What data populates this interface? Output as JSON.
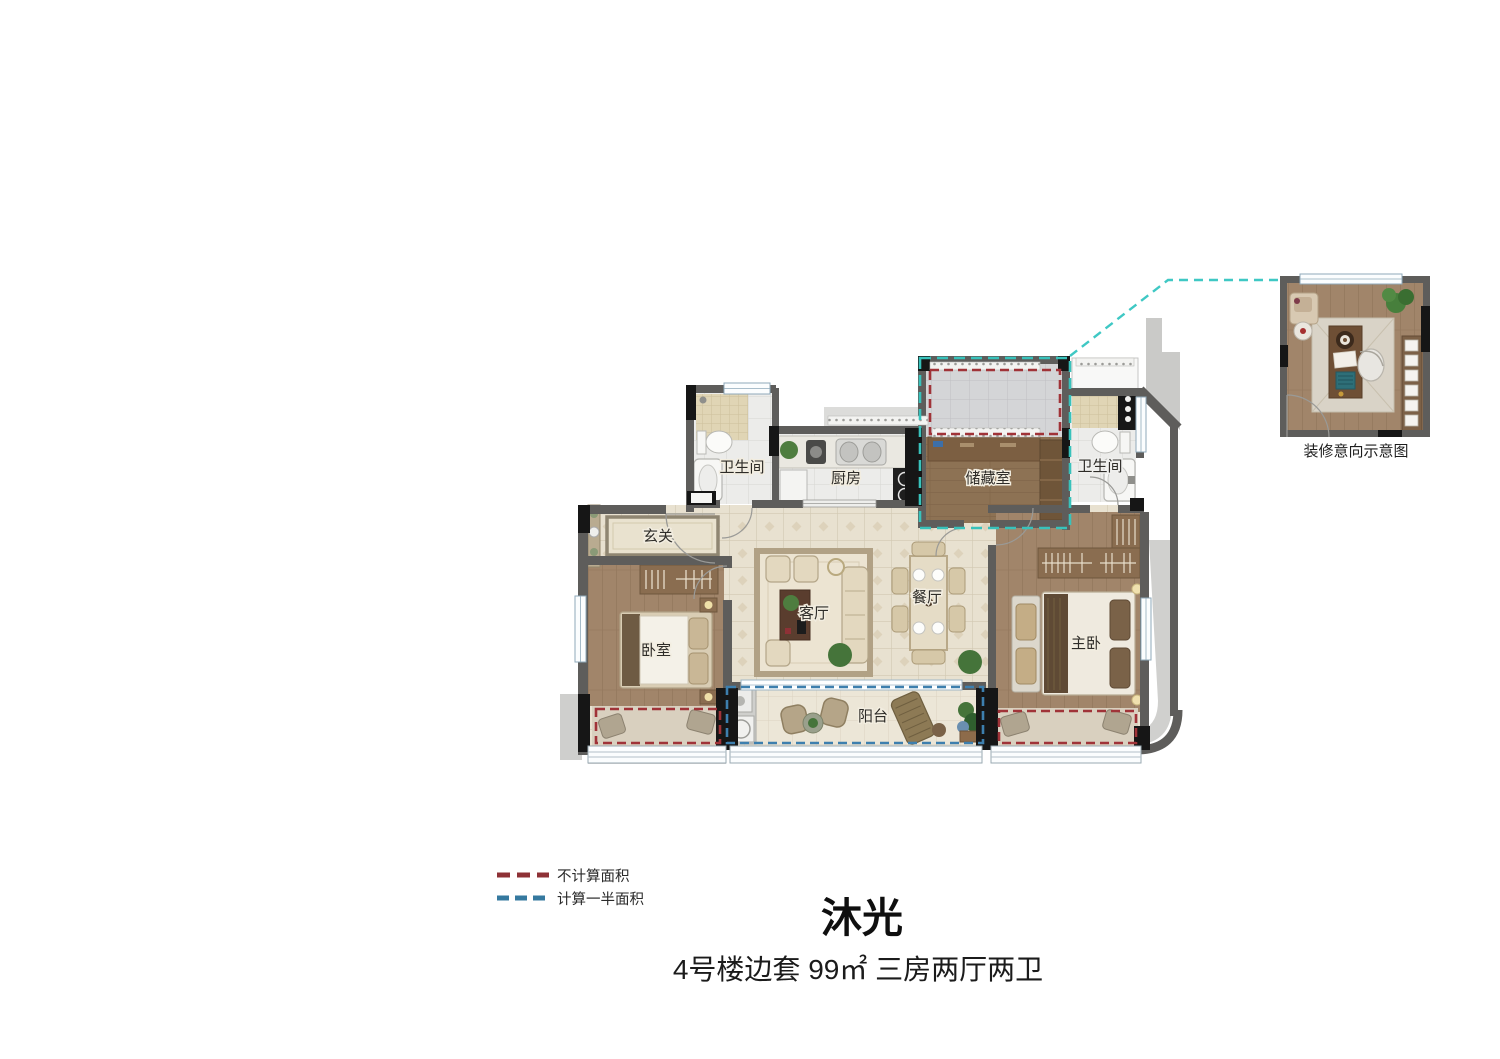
{
  "title": "沐光",
  "subtitle": "4号楼边套 99㎡ 三房两厅两卫",
  "detail_caption": "装修意向示意图",
  "legend": {
    "not_counted": {
      "label": "不计算面积",
      "color": "#8e3136"
    },
    "half_counted": {
      "label": "计算一半面积",
      "color": "#35799f"
    }
  },
  "rooms": {
    "bath_left": "卫生间",
    "kitchen": "厨房",
    "storage": "储藏室",
    "bath_right": "卫生间",
    "foyer": "玄关",
    "living": "客厅",
    "dining": "餐厅",
    "bedroom": "卧室",
    "master": "主卧",
    "balcony": "阳台"
  },
  "colors": {
    "wall": "#5e5d5b",
    "column": "#161616",
    "teal_outline": "#38c2bb",
    "red_dash": "#a03338",
    "blue_dash": "#3d7fae"
  }
}
